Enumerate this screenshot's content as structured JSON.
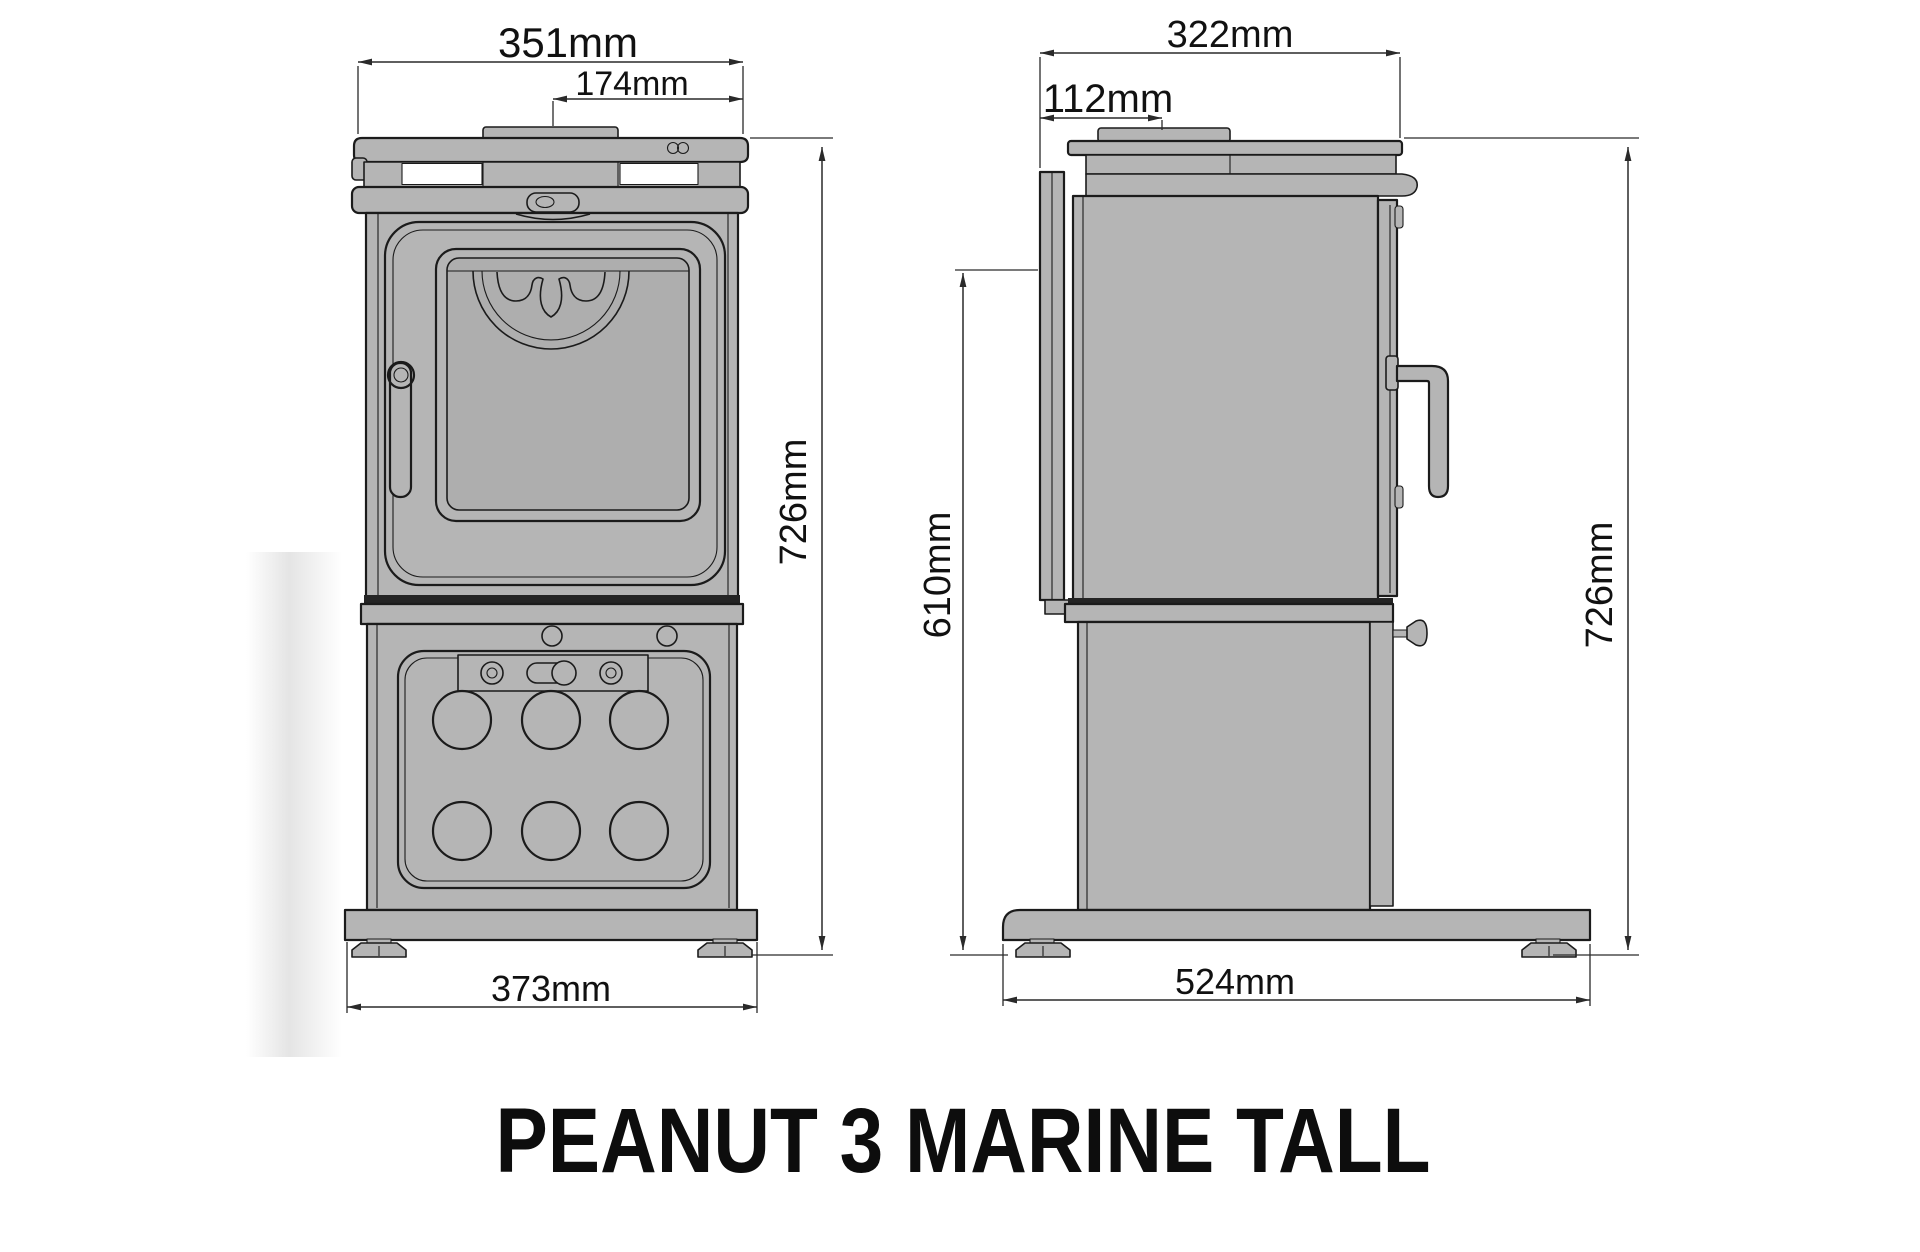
{
  "title": "PEANUT 3 MARINE TALL",
  "front_view": {
    "name": "stove front elevation",
    "plate_mark_icon": "peanut-infinity-mark",
    "dims": {
      "top_width": "351mm",
      "flue_to_edge": "174mm",
      "overall_height": "726mm",
      "base_width": "373mm"
    }
  },
  "side_view": {
    "name": "stove side elevation",
    "dims": {
      "top_depth": "322mm",
      "rear_to_flue": "112mm",
      "rear_shield_height": "610mm",
      "overall_height": "726mm",
      "base_depth": "524mm"
    }
  },
  "colors": {
    "background": "#ffffff",
    "stove_body": "#b5b5b5",
    "glass": "#aeaeae",
    "outline": "#1b1b1b",
    "dimension_lines": "#2a2a2a",
    "text": "#111111"
  }
}
